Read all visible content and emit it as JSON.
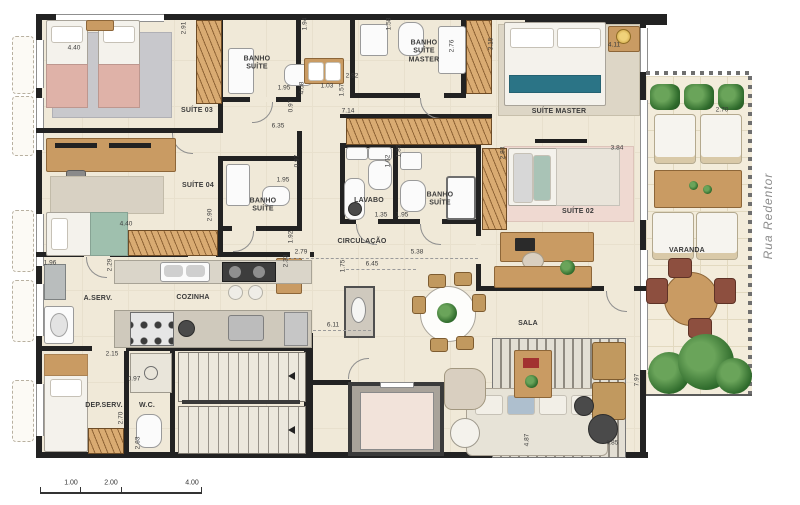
{
  "plan": {
    "street": "Rua Redentor",
    "scale": [
      "1.00",
      "2.00",
      "4.00"
    ],
    "rooms": {
      "suite03": "SUÍTE 03",
      "banho_suite03": "BANHO SUÍTE",
      "banho_suite_master": "BANHO SUÍTE MASTER",
      "suite_master": "SUÍTE MASTER",
      "suite04": "SUÍTE 04",
      "banho_suite04": "BANHO SUÍTE",
      "lavabo": "LAVABO",
      "banho_suite02": "BANHO SUÍTE",
      "circulacao": "CIRCULAÇÃO",
      "suite02": "SUÍTE 02",
      "varanda": "VARANDA",
      "area_servico": "A.SERV.",
      "cozinha": "COZINHA",
      "dep_servico": "DEP.SERV.",
      "wc": "W.C.",
      "sala": "SALA"
    },
    "dims": [
      "4.40",
      "2.91",
      "1.94",
      "1.95",
      "0.97",
      "4.08",
      "1.03",
      "2.92",
      "1.58",
      "1.57",
      "2.76",
      "3.15",
      "4.11",
      "2.70",
      "7.14",
      "6.35",
      "1.86",
      "1.62",
      "1.35",
      "1.95",
      "2.83",
      "3.84",
      "1.92",
      "2.33",
      "2.79",
      "5.38",
      "6.45",
      "1.75",
      "0.97",
      "1.95",
      "4.40",
      "2.90",
      "1.96",
      "2.29",
      "2.15",
      "0.97",
      "2.70",
      "2.63",
      "6.11",
      "4.87",
      "4.85",
      "7.97"
    ],
    "colors": {
      "wall": "#222222",
      "floor": "#f0e9d8",
      "wood": "#c99b63",
      "accent_teal": "#2b7486",
      "plant_green": "#2f6b2c"
    }
  }
}
